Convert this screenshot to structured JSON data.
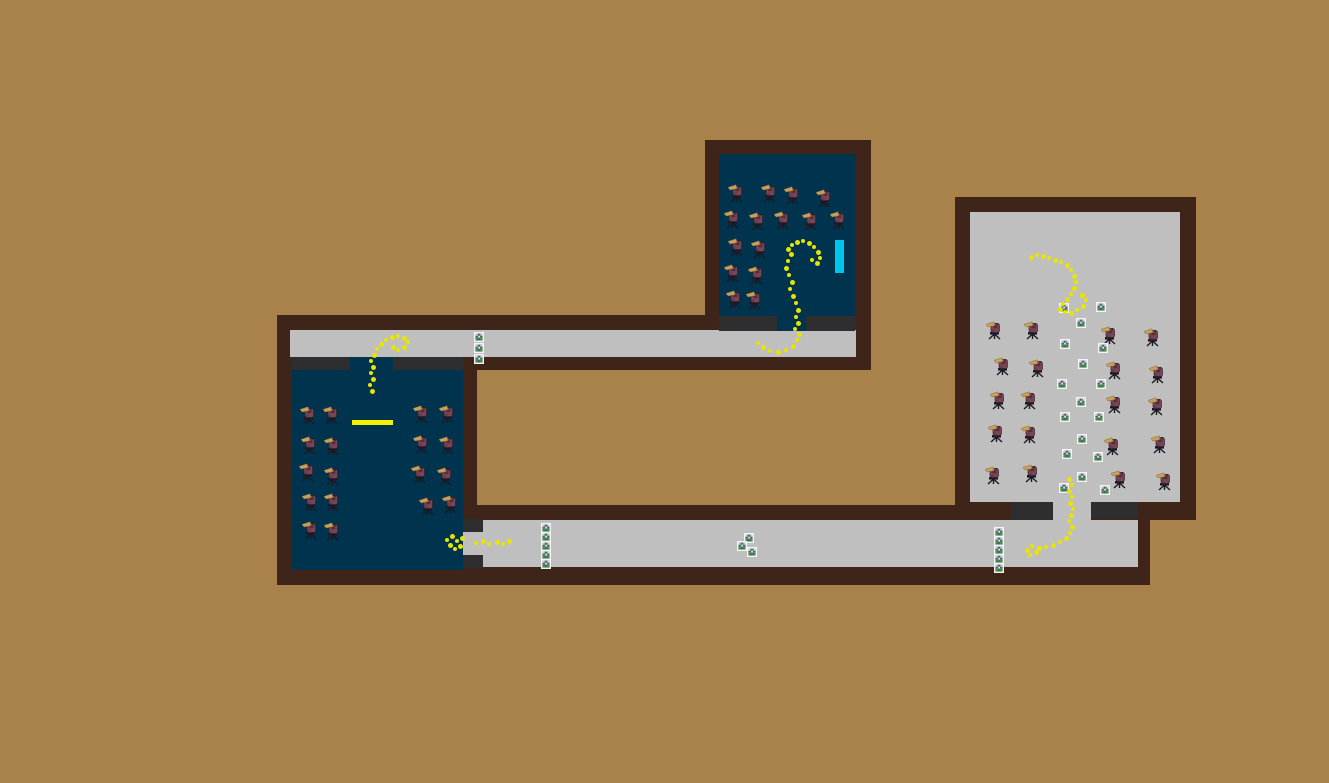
{
  "scene": {
    "width": 1329,
    "height": 783,
    "background": "#a8824a",
    "colors": {
      "wall": "#3e2419",
      "floor_dark": "#00334d",
      "floor_light": "#c0bfbf",
      "threshold": "#2e2e30",
      "trail": "#e8e400",
      "board_cyan": "#00c4ea",
      "desk_yellow": "#f2ef00",
      "icon_frame": "#f4f4f4",
      "npc_body": "#7a4656",
      "npc_beak": "#c8a05c",
      "npc_chair": "#1a1a26"
    },
    "rects": [
      {
        "name": "top-structure-wall",
        "color": "wall",
        "x": 277,
        "y": 315,
        "w": 594,
        "h": 55,
        "interactable": false
      },
      {
        "name": "top-room-wall",
        "color": "wall",
        "x": 705,
        "y": 140,
        "w": 166,
        "h": 180,
        "interactable": false
      },
      {
        "name": "left-room-wall",
        "color": "wall",
        "x": 277,
        "y": 357,
        "w": 200,
        "h": 228,
        "interactable": false
      },
      {
        "name": "bottom-corridor-wall",
        "color": "wall",
        "x": 463,
        "y": 505,
        "w": 687,
        "h": 80,
        "interactable": false
      },
      {
        "name": "right-room-wall",
        "color": "wall",
        "x": 955,
        "y": 197,
        "w": 241,
        "h": 323,
        "interactable": false
      },
      {
        "name": "top-corridor-floor",
        "color": "floor_light",
        "x": 290,
        "y": 330,
        "w": 566,
        "h": 27,
        "interactable": true
      },
      {
        "name": "top-room-floor",
        "color": "floor_dark",
        "x": 719,
        "y": 154,
        "w": 136,
        "h": 162,
        "interactable": true
      },
      {
        "name": "top-room-threshold-left",
        "color": "threshold",
        "x": 719,
        "y": 316,
        "w": 58,
        "h": 15,
        "interactable": false
      },
      {
        "name": "top-room-doorway",
        "color": "floor_dark",
        "x": 777,
        "y": 316,
        "w": 29,
        "h": 15,
        "interactable": true
      },
      {
        "name": "top-room-threshold-right",
        "color": "threshold",
        "x": 806,
        "y": 316,
        "w": 49,
        "h": 15,
        "interactable": false
      },
      {
        "name": "left-room-floor",
        "color": "floor_dark",
        "x": 292,
        "y": 370,
        "w": 171,
        "h": 200,
        "interactable": true
      },
      {
        "name": "left-room-threshold-left",
        "color": "threshold",
        "x": 292,
        "y": 357,
        "w": 58,
        "h": 13,
        "interactable": false
      },
      {
        "name": "left-room-doorway",
        "color": "floor_dark",
        "x": 350,
        "y": 357,
        "w": 43,
        "h": 13,
        "interactable": true
      },
      {
        "name": "left-room-threshold-right",
        "color": "threshold",
        "x": 393,
        "y": 357,
        "w": 70,
        "h": 13,
        "interactable": false
      },
      {
        "name": "bottom-corridor-floor",
        "color": "floor_light",
        "x": 483,
        "y": 520,
        "w": 655,
        "h": 47,
        "interactable": true
      },
      {
        "name": "left-room-side-threshold-top",
        "color": "threshold",
        "x": 463,
        "y": 519,
        "w": 20,
        "h": 13,
        "interactable": false
      },
      {
        "name": "left-room-side-doorway",
        "color": "floor_light",
        "x": 463,
        "y": 532,
        "w": 20,
        "h": 23,
        "interactable": true
      },
      {
        "name": "left-room-side-threshold-bottom",
        "color": "threshold",
        "x": 463,
        "y": 555,
        "w": 20,
        "h": 13,
        "interactable": false
      },
      {
        "name": "right-room-floor",
        "color": "floor_light",
        "x": 970,
        "y": 212,
        "w": 210,
        "h": 290,
        "interactable": true
      },
      {
        "name": "right-room-threshold-left",
        "color": "threshold",
        "x": 1011,
        "y": 502,
        "w": 42,
        "h": 18,
        "interactable": false
      },
      {
        "name": "right-room-doorway",
        "color": "floor_light",
        "x": 1053,
        "y": 502,
        "w": 38,
        "h": 18,
        "interactable": true
      },
      {
        "name": "right-room-threshold-right",
        "color": "threshold",
        "x": 1091,
        "y": 502,
        "w": 47,
        "h": 16,
        "interactable": false
      },
      {
        "name": "cyan-board",
        "color": "board_cyan",
        "x": 835,
        "y": 240,
        "w": 9,
        "h": 33,
        "interactable": true
      },
      {
        "name": "yellow-desk",
        "color": "desk_yellow",
        "x": 352,
        "y": 420,
        "w": 41,
        "h": 5,
        "interactable": true
      }
    ],
    "npcs": {
      "sprite": "seated-bird-figure",
      "groups": [
        {
          "room": "top-room",
          "positions": [
            [
              728,
              183
            ],
            [
              761,
              183
            ],
            [
              784,
              185
            ],
            [
              816,
              188
            ],
            [
              724,
              209
            ],
            [
              749,
              211
            ],
            [
              774,
              210
            ],
            [
              802,
              211
            ],
            [
              830,
              210
            ],
            [
              728,
              237
            ],
            [
              751,
              239
            ],
            [
              724,
              263
            ],
            [
              748,
              265
            ],
            [
              726,
              289
            ],
            [
              746,
              290
            ]
          ]
        },
        {
          "room": "left-room",
          "positions": [
            [
              300,
              405
            ],
            [
              323,
              405
            ],
            [
              301,
              435
            ],
            [
              324,
              436
            ],
            [
              299,
              462
            ],
            [
              324,
              466
            ],
            [
              302,
              492
            ],
            [
              324,
              492
            ],
            [
              302,
              520
            ],
            [
              324,
              521
            ],
            [
              413,
              404
            ],
            [
              439,
              404
            ],
            [
              413,
              434
            ],
            [
              439,
              435
            ],
            [
              411,
              464
            ],
            [
              437,
              466
            ],
            [
              419,
              496
            ],
            [
              442,
              494
            ]
          ]
        },
        {
          "room": "right-room",
          "positions": [
            [
              986,
              320
            ],
            [
              1024,
              320
            ],
            [
              994,
              356
            ],
            [
              1029,
              358
            ],
            [
              990,
              390
            ],
            [
              1021,
              390
            ],
            [
              988,
              423
            ],
            [
              1021,
              424
            ],
            [
              985,
              465
            ],
            [
              1023,
              463
            ],
            [
              1101,
              325
            ],
            [
              1144,
              327
            ],
            [
              1106,
              360
            ],
            [
              1149,
              364
            ],
            [
              1106,
              394
            ],
            [
              1148,
              396
            ],
            [
              1104,
              436
            ],
            [
              1151,
              434
            ],
            [
              1111,
              469
            ],
            [
              1156,
              471
            ]
          ]
        }
      ]
    },
    "items": {
      "icon": "framed-picture-tile",
      "groups": [
        {
          "area": "top-corridor-stack",
          "positions": [
            [
              474,
              332
            ],
            [
              474,
              343
            ],
            [
              474,
              354
            ]
          ]
        },
        {
          "area": "bottom-corridor-left-stack",
          "positions": [
            [
              541,
              523
            ],
            [
              541,
              532
            ],
            [
              541,
              541
            ],
            [
              541,
              550
            ],
            [
              541,
              559
            ]
          ]
        },
        {
          "area": "bottom-corridor-middle-cluster",
          "positions": [
            [
              744,
              533
            ],
            [
              737,
              541
            ],
            [
              747,
              547
            ]
          ]
        },
        {
          "area": "bottom-corridor-right-stack",
          "positions": [
            [
              994,
              527
            ],
            [
              994,
              536
            ],
            [
              994,
              545
            ],
            [
              994,
              554
            ],
            [
              994,
              563
            ]
          ]
        },
        {
          "area": "right-room-column",
          "positions": [
            [
              1059,
              303
            ],
            [
              1096,
              302
            ],
            [
              1076,
              318
            ],
            [
              1060,
              339
            ],
            [
              1098,
              343
            ],
            [
              1078,
              359
            ],
            [
              1057,
              379
            ],
            [
              1096,
              379
            ],
            [
              1076,
              397
            ],
            [
              1060,
              412
            ],
            [
              1094,
              412
            ],
            [
              1077,
              434
            ],
            [
              1062,
              449
            ],
            [
              1093,
              452
            ],
            [
              1077,
              472
            ],
            [
              1059,
              483
            ],
            [
              1100,
              485
            ]
          ]
        }
      ]
    },
    "trails": {
      "color": "#e8e400",
      "paths": [
        {
          "name": "top-room-exit-trail",
          "points": [
            [
              788,
              249
            ],
            [
              792,
              245
            ],
            [
              797,
              242
            ],
            [
              803,
              241
            ],
            [
              809,
              243
            ],
            [
              814,
              247
            ],
            [
              818,
              252
            ],
            [
              820,
              258
            ],
            [
              817,
              263
            ],
            [
              812,
              260
            ],
            [
              791,
              254
            ],
            [
              788,
              261
            ],
            [
              786,
              268
            ],
            [
              789,
              275
            ],
            [
              792,
              282
            ],
            [
              790,
              289
            ],
            [
              793,
              296
            ],
            [
              796,
              303
            ],
            [
              798,
              310
            ],
            [
              796,
              317
            ],
            [
              798,
              323
            ],
            [
              795,
              329
            ],
            [
              799,
              334
            ],
            [
              797,
              340
            ],
            [
              793,
              346
            ],
            [
              786,
              350
            ],
            [
              778,
              352
            ],
            [
              770,
              351
            ],
            [
              763,
              347
            ],
            [
              758,
              343
            ]
          ]
        },
        {
          "name": "left-room-top-doorway-trail",
          "points": [
            [
              372,
              391
            ],
            [
              370,
              385
            ],
            [
              373,
              379
            ],
            [
              371,
              373
            ],
            [
              373,
              367
            ],
            [
              371,
              361
            ],
            [
              374,
              355
            ],
            [
              377,
              349
            ],
            [
              381,
              344
            ],
            [
              386,
              340
            ],
            [
              392,
              337
            ],
            [
              398,
              336
            ],
            [
              404,
              338
            ],
            [
              408,
              342
            ],
            [
              404,
              347
            ],
            [
              398,
              350
            ],
            [
              393,
              347
            ]
          ]
        },
        {
          "name": "left-room-side-exit-trail",
          "points": [
            [
              452,
              536
            ],
            [
              447,
              540
            ],
            [
              450,
              545
            ],
            [
              455,
              549
            ],
            [
              460,
              546
            ],
            [
              457,
              541
            ],
            [
              462,
              538
            ],
            [
              476,
              543
            ],
            [
              483,
              541
            ],
            [
              489,
              544
            ],
            [
              497,
              542
            ],
            [
              503,
              544
            ],
            [
              509,
              541
            ]
          ]
        },
        {
          "name": "right-room-top-trail",
          "points": [
            [
              1031,
              257
            ],
            [
              1037,
              255
            ],
            [
              1043,
              256
            ],
            [
              1049,
              258
            ],
            [
              1055,
              260
            ],
            [
              1061,
              262
            ],
            [
              1067,
              265
            ],
            [
              1071,
              270
            ],
            [
              1074,
              276
            ],
            [
              1076,
              282
            ],
            [
              1074,
              288
            ],
            [
              1071,
              294
            ],
            [
              1067,
              299
            ],
            [
              1063,
              304
            ],
            [
              1060,
              309
            ],
            [
              1065,
              312
            ],
            [
              1071,
              313
            ],
            [
              1077,
              310
            ],
            [
              1083,
              306
            ],
            [
              1086,
              300
            ],
            [
              1082,
              295
            ]
          ]
        },
        {
          "name": "right-room-bottom-exit-trail",
          "points": [
            [
              1069,
              479
            ],
            [
              1072,
              485
            ],
            [
              1069,
              491
            ],
            [
              1072,
              497
            ],
            [
              1070,
              503
            ],
            [
              1073,
              509
            ],
            [
              1071,
              515
            ],
            [
              1069,
              521
            ],
            [
              1072,
              527
            ],
            [
              1070,
              533
            ],
            [
              1066,
              538
            ],
            [
              1060,
              542
            ],
            [
              1053,
              545
            ],
            [
              1046,
              547
            ],
            [
              1039,
              548
            ],
            [
              1032,
              546
            ],
            [
              1027,
              550
            ],
            [
              1030,
              555
            ],
            [
              1036,
              552
            ]
          ]
        }
      ]
    }
  }
}
